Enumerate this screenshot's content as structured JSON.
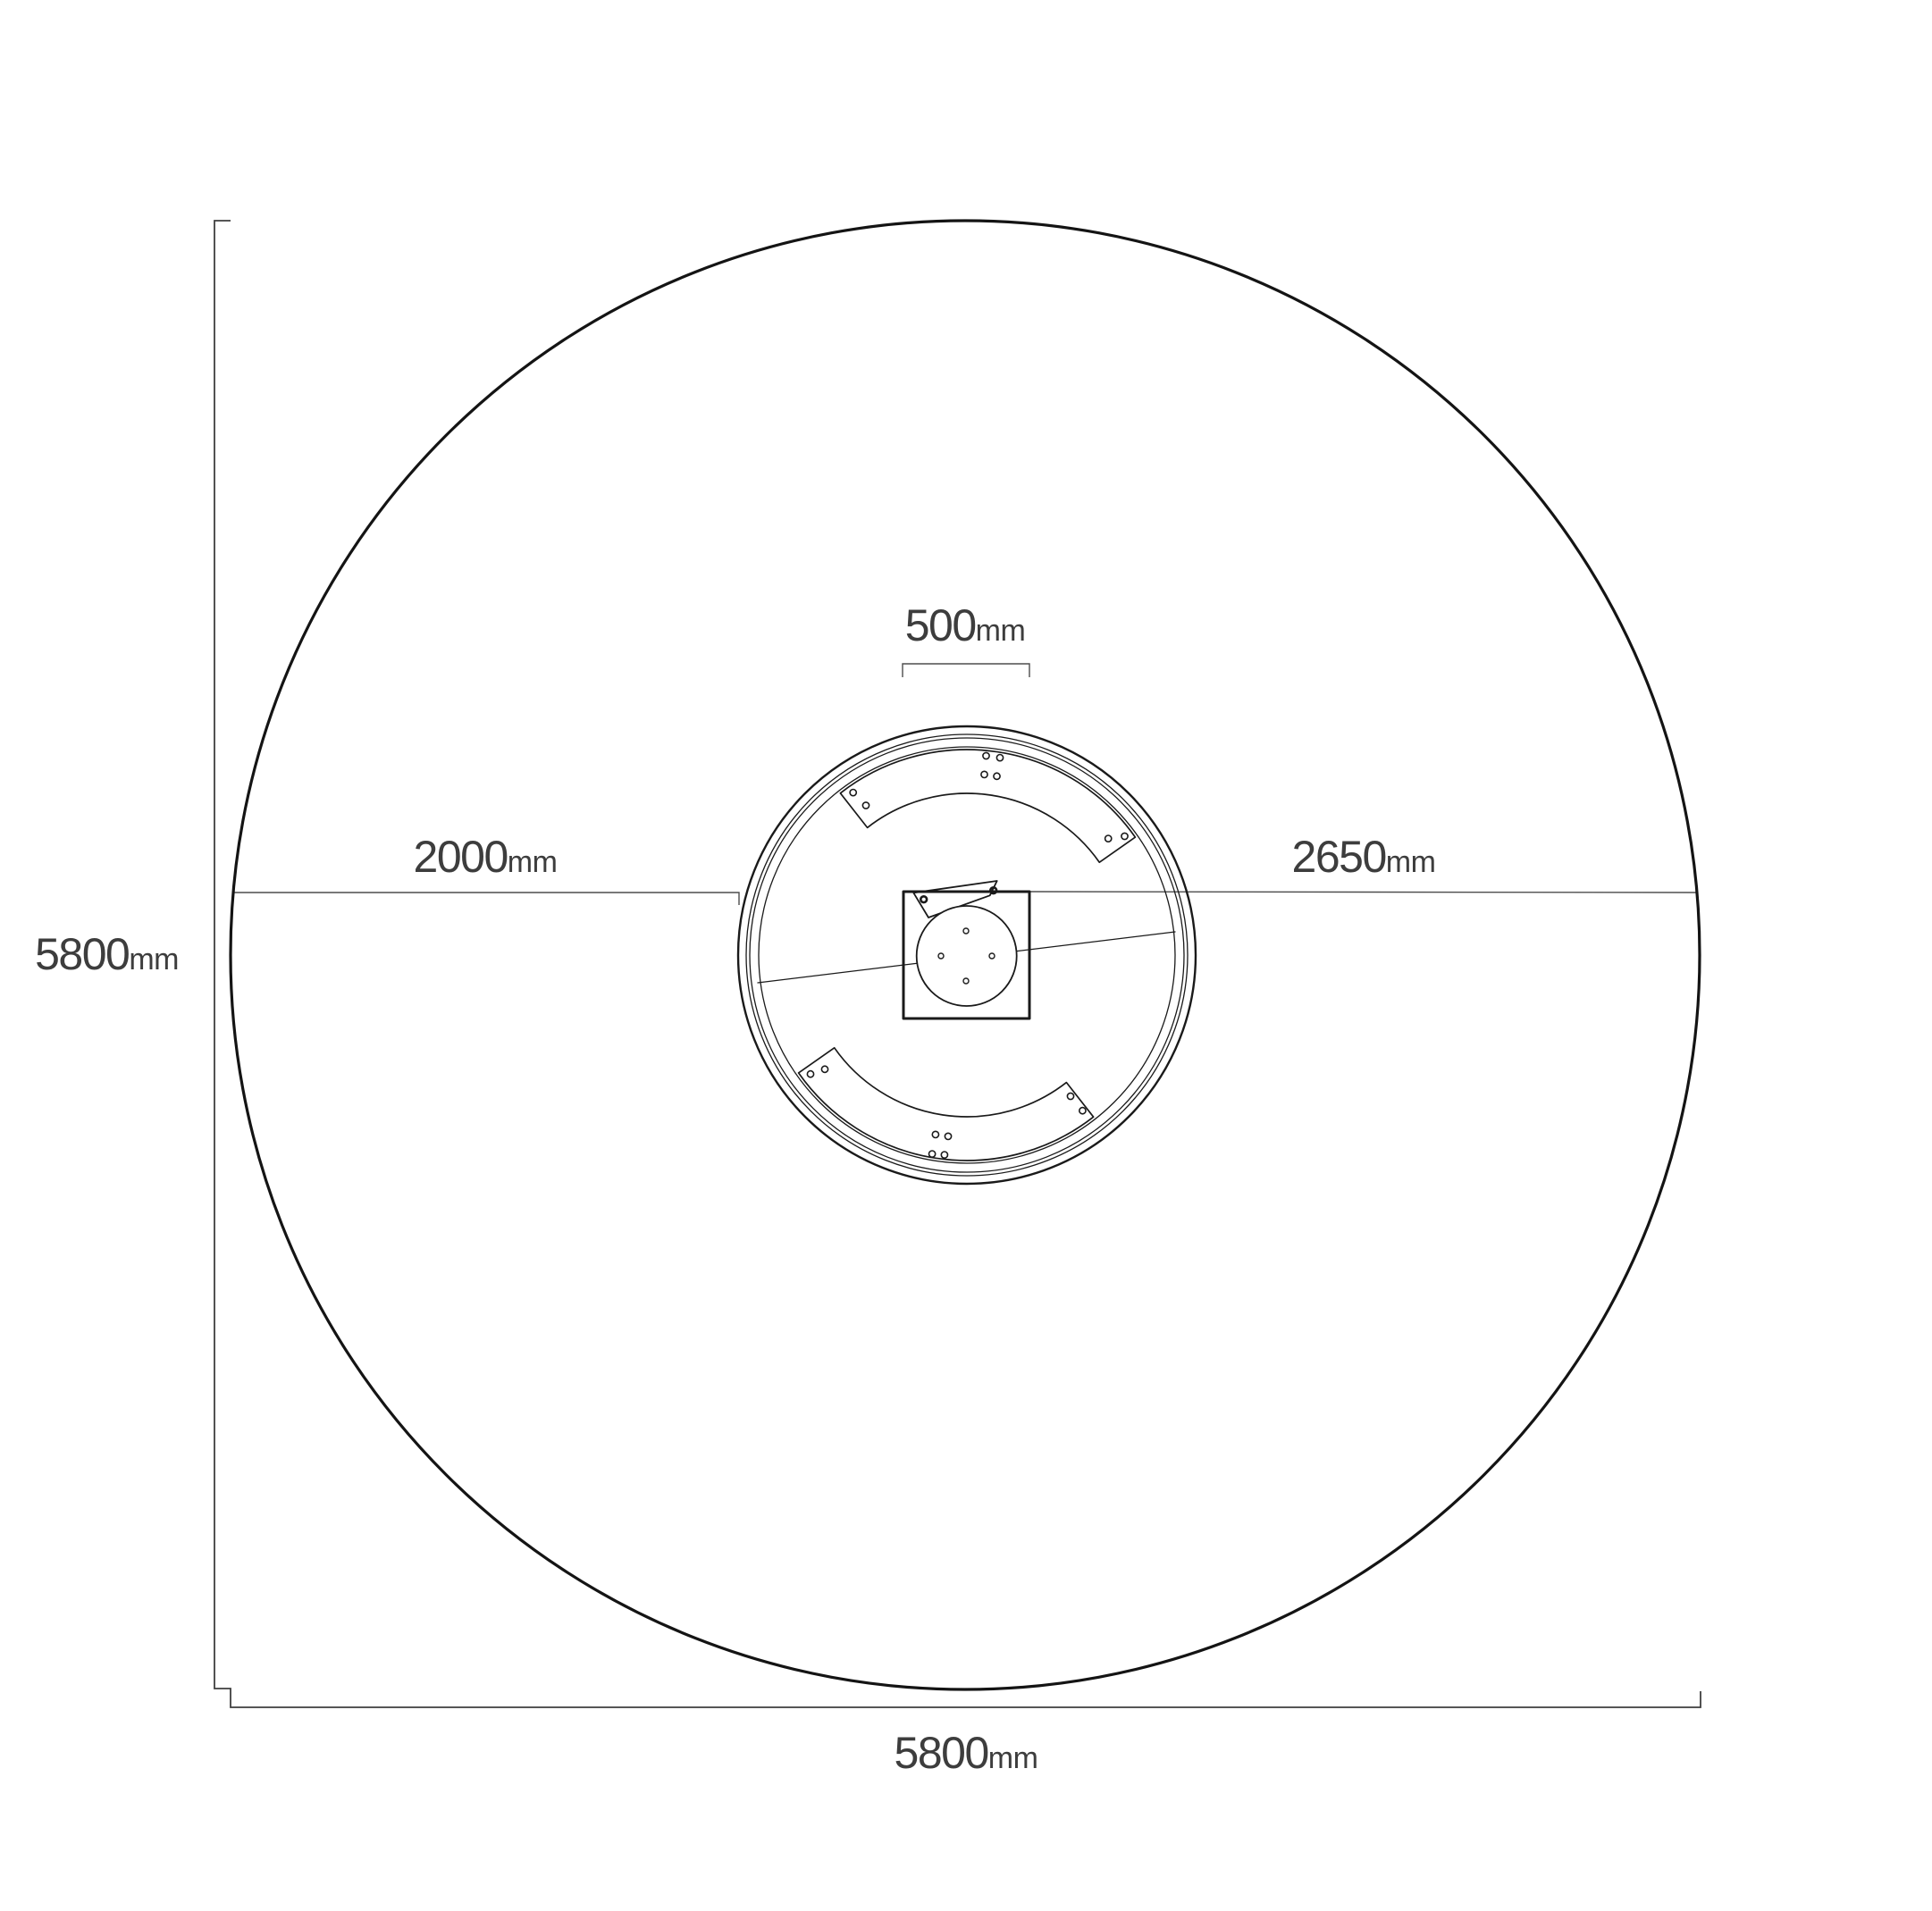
{
  "drawing": {
    "labels": {
      "overall_height": {
        "value": "5800",
        "unit": "mm"
      },
      "overall_width": {
        "value": "5800",
        "unit": "mm"
      },
      "left_span": {
        "value": "2000",
        "unit": "mm"
      },
      "right_span": {
        "value": "2650",
        "unit": "mm"
      },
      "hub_width": {
        "value": "500",
        "unit": "mm"
      }
    },
    "colors": {
      "background": "#ffffff",
      "outline": "#141414",
      "detail_line": "#1a1a1a",
      "dimension_line": "#4d4d4d",
      "label_text": "#3d3d3d"
    }
  }
}
